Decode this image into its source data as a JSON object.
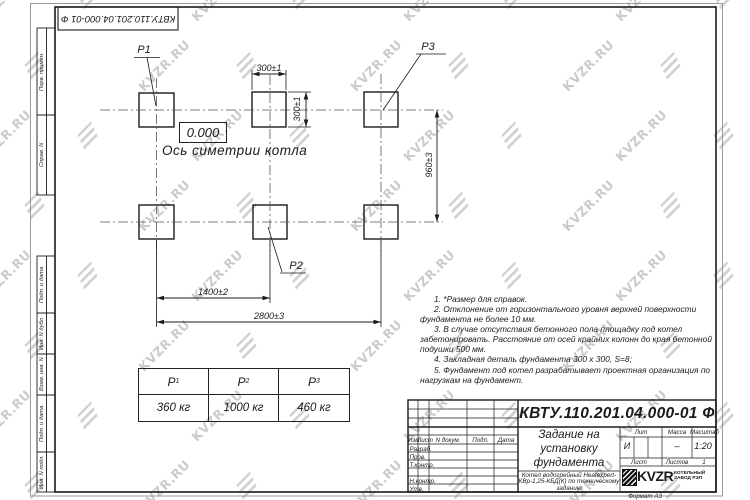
{
  "watermark": {
    "text": "KVZR.RU"
  },
  "stamp_top": "КВТУ.110.201.04.000-01 Ф",
  "margin_labels": [
    "Перв. примен.",
    "Справ. N",
    "Подп. и дата",
    "Инв. N дубл.",
    "Взам. инв. N",
    "Подп. и дата",
    "Инв. N подл."
  ],
  "drawing": {
    "point_labels": {
      "p1": "P1",
      "p2": "P2",
      "p3": "P3"
    },
    "zero_level": "0.000",
    "axis_label": "Ось симетрии котла",
    "dimensions": {
      "pad_width": "300±1",
      "pad_height": "300±1",
      "row_spacing": "960±3",
      "col_half": "1400±2",
      "col_full": "2800±3"
    }
  },
  "loads_table": {
    "headers": [
      {
        "base": "P",
        "sub": "1"
      },
      {
        "base": "P",
        "sub": "2"
      },
      {
        "base": "P",
        "sub": "3"
      }
    ],
    "values": [
      "360 кг",
      "1000 кг",
      "460 кг"
    ]
  },
  "notes": [
    "1. *Размер для справок.",
    "2. Отклонение от горизонтального уровня верхней поверхности фундамента не более 10 мм.",
    "3. В случае отсутствия бетонного пола площадку под котел забетонировать. Расстояние от осей крайних колонн до края бетонной подушки 500 мм.",
    "4. Закладная деталь фундамента 300 x 300, S=8;",
    "5. Фундамент под котел разрабатывает проектная организация по нагрузкам на фундамент."
  ],
  "title_block": {
    "doc_number": "КВТУ.110.201.04.000-01 Ф",
    "title": "Задание на установку фундамента",
    "subtitle": "Котел водогрейный Heatexpert-КВр-1,25-КБД(К) по техническому заданию",
    "rev_headers": [
      "Изм",
      "Лист",
      "N докум.",
      "Подп.",
      "Дата"
    ],
    "row_labels": [
      "Разраб.",
      "Пров.",
      "Т.контр.",
      "Н.контр.",
      "Утв."
    ],
    "lit_label": "Лит",
    "mass_label": "Масса",
    "scale_label": "Масштаб",
    "lit_value": "И",
    "mass_value": "–",
    "scale_value": "1:20",
    "sheet_label": "Лист",
    "sheets_label": "Листов",
    "sheets_value": "1",
    "logo_text": "KVZR",
    "logo_caption": "КОТЕЛЬНЫЙ ЗАВОД РЭП",
    "format_label": "Формат А3"
  }
}
